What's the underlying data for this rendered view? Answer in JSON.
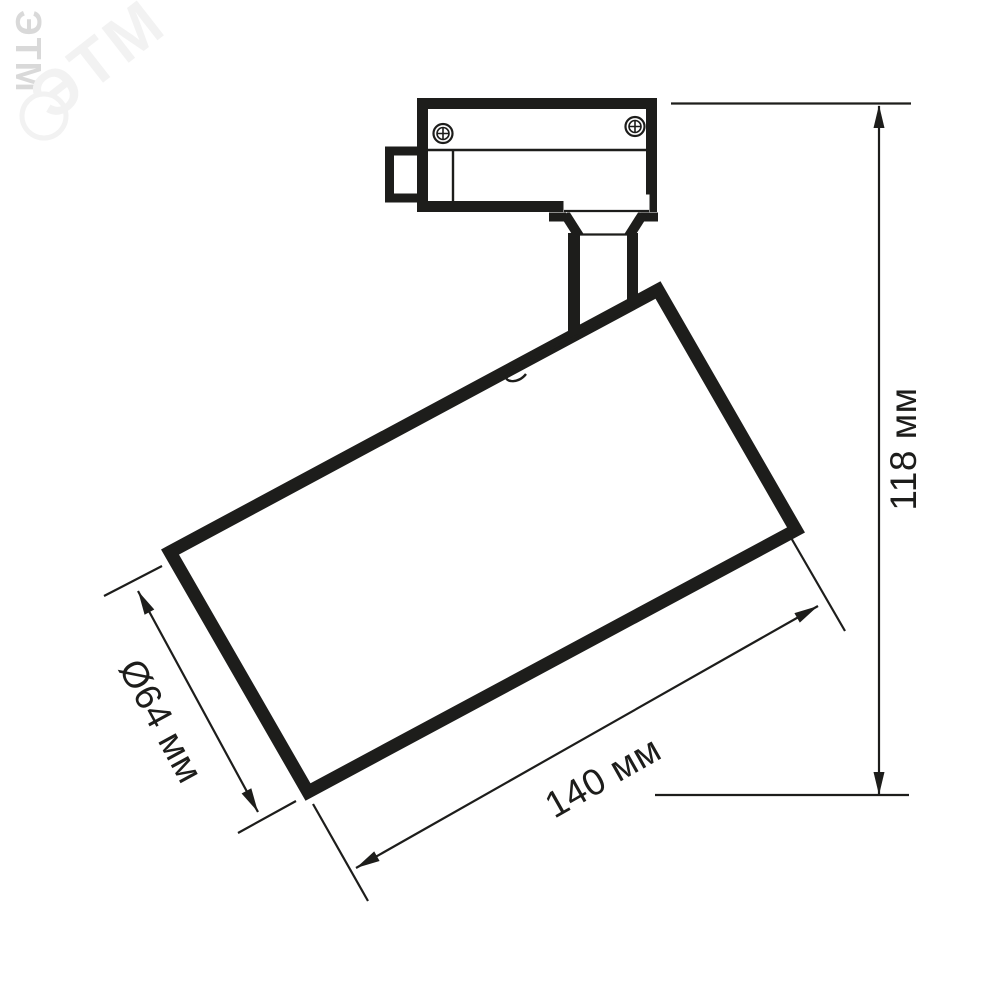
{
  "watermark": {
    "text": "ЭТМ",
    "edge_color": "#d9d9d9",
    "logo_color": "#f2f2f2"
  },
  "diagram": {
    "colors": {
      "line": "#1d1d1b",
      "background": "#ffffff"
    },
    "labels": {
      "height": "118 мм",
      "length": "140 мм",
      "diameter": "Ø64 мм"
    }
  }
}
